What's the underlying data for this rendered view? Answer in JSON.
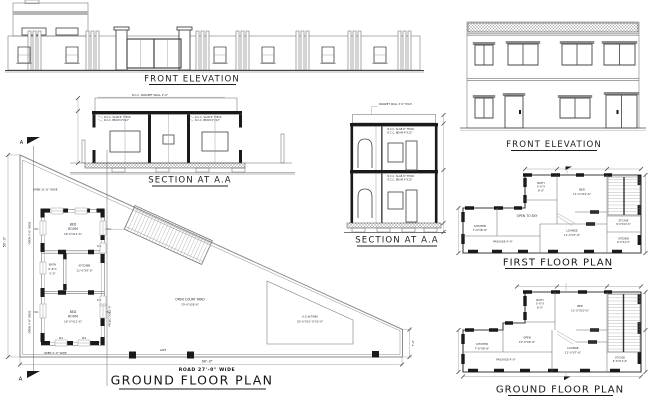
{
  "titles": {
    "left_elevation": "FRONT ELEVATION",
    "left_section": "SECTION AT A.A",
    "main_plan": "GROUND FLOOR PLAN",
    "right_section": "SECTION AT A.A",
    "right_elevation": "FRONT ELEVATION",
    "first_floor": "FIRST FLOOR PLAN",
    "ground_floor": "GROUND FLOOR PLAN"
  },
  "ls": {
    "parapet": "R.C.C. PARAPET WALL 2'-0\"",
    "slab": "R.C.C. SLAB 6\" THICK",
    "beam": "R.C.C. BEAM 9\"X12\""
  },
  "rs": {
    "parapet": "PARAPET WALL 3'-0\" HIGH",
    "slab": "R.C.C. SLAB 6\" THICK",
    "beam": "R.C.C. BEAM 9\"X12\""
  },
  "mp": {
    "bed_l1": "BED",
    "bed_l2": "ROOM",
    "bed_dim": "16'-0\"X11'-6\"",
    "bath_l": "BATH",
    "bath_d1": "6'-6\"X",
    "bath_d2": "5'-0\"",
    "kit_l": "KITCHEN",
    "kit_dim": "11'-0\"X9'-0\"",
    "court_l": "OPEN COURT YARD",
    "court_dim": "70'-0\"X28'-6\"",
    "tank_l": "U.G.W.TANK",
    "tank_dim": "20'-0\"X15'-0\"X3'-0\"",
    "open_top": "OPEN 11'-6\" WIDE",
    "open_left": "OPEN 3'-6\" WIDE",
    "open_bottom": "OPEN 3'-0\" WIDE",
    "projection": "PROJECTION 2'-0\"",
    "gate": "GATE",
    "dim_w": "90'-3\"",
    "dim_h": "50'-3\"",
    "dim_r": "7'-0\"",
    "road": "ROAD 27'-0\" WIDE",
    "marker": "A",
    "w1": "W.1",
    "w2": "W.2",
    "d1": "D.1"
  },
  "ff": {
    "bath_l": "BATH",
    "bath_d1": "5'-0\"X",
    "bath_d2": "6'-0\"",
    "bed_l": "BED",
    "bed_dim": "11'-0\"X10'-6\"",
    "st_l": "ST-CASE",
    "st_dim": "8'-0\"X13'-6\"",
    "open_sky": "OPEN TO SKY",
    "kit_l": "KITCHEN",
    "kit_dim": "7'-6\"X8'-6\"",
    "passage": "PASSAGE 4'-0\"",
    "lounge_l": "LOUNGE",
    "lounge_dim": "11'-0\"X7'-6\"",
    "kit2_l": "KITCHEN",
    "kit2_dim": "8'-0\"X4'-0\""
  },
  "gf": {
    "bath_l": "BATH",
    "bath_d1": "5'-0\"X",
    "bath_d2": "6'-0\"",
    "bed_l": "BED",
    "bed_dim": "11'-0\"X10'-6\"",
    "open_l": "OPEN",
    "open_dim": "10'-0\"X8'-6\"",
    "kit_l": "KITCHEN",
    "kit_dim": "7'-6\"X8'-6\"",
    "passage": "PASSAGE 4'-0\"",
    "lounge_l": "LOUNGE",
    "lounge_dim": "11'-0\"X7'-6\"",
    "st_l": "ST-CASE",
    "st_dim": "8'-0\"X13'-6\""
  },
  "colors": {
    "background": "#ffffff",
    "line_gray": "#7a7a7a",
    "wall_black": "#1a1a1a",
    "text_navy": "#1d2335",
    "band_gray": "#b5b5b5"
  }
}
